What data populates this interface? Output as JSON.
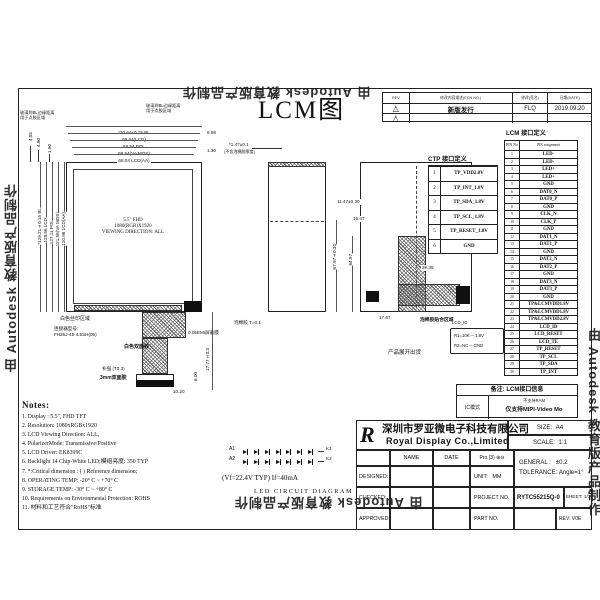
{
  "watermark": "由 Autodesk 教育版产品制作",
  "page_title": "LCM图",
  "revision_table": {
    "headers": [
      "REV",
      "修改内容描述(ECN NO.)",
      "修改(签名)",
      "日期(DATE)"
    ],
    "rows": [
      {
        "mark": "1",
        "desc": "新版发行",
        "by": "FLQ",
        "date": "2019.09.20"
      },
      {
        "mark": "2",
        "desc": "",
        "by": "",
        "date": ""
      }
    ]
  },
  "front_view": {
    "h_dims": [
      "*70.64±0.15 BL",
      "69.64(LCD)",
      "69.54 POL",
      "68.64(VA MOS)",
      "68.04 LCD(AA)"
    ],
    "h_side_dims": [
      "6.58",
      "1.30"
    ],
    "v_dims": [
      "*129.21±0.15 BL",
      "128.56 LCD",
      "127.11 POL",
      "121.56(VA MOS)",
      "120.96 LCD(AA)"
    ],
    "corner_dims": [
      "4.55",
      "4.60",
      "1.50"
    ],
    "glass_note_line1": "玻璃到BL边缘距离",
    "glass_note_line2": "用于点胶区域",
    "panel_label": [
      "5.5\" FHD",
      "1080(RGB)X1920",
      "VIEWING DIRECTION: ALL"
    ]
  },
  "fpc": {
    "silk_note": "白色丝印区域",
    "connector_note1": "连接器型号:",
    "connector_note2": "FH26J-45-4.5SH(05)",
    "emi_note": "0.05EMI屏蔽膜",
    "white_tape_note": "白色双面胶",
    "stiffener_note": "补强 (T0.3)",
    "tape_note": "3mm双面胶",
    "dim_w": "10.20",
    "dim_h": "6.00",
    "dim_len": "17.77±0.3"
  },
  "side_view": {
    "thickness_dim": "*1.47±0.1",
    "thickness_note": "(不含泡棉胶厚度)",
    "foam_note": "泡棉胶 T=0.1"
  },
  "back_view": {
    "dim1": "11.47±0.30",
    "dim2": "16.47",
    "dim3": "67.97±0.30",
    "dim4": "64.97",
    "dim5": "39.35",
    "dim6": "17.67",
    "foam_note": "泡棉胶贴合区域",
    "ship_note": "产品展开出货",
    "io_label": "LCD_IO",
    "io_r1": "R1=10K ─ 1.8V",
    "io_r2": "R2=NC ─ GND"
  },
  "ctp_table": {
    "title": "CTP 接口定义",
    "rows": [
      [
        "1",
        "TP_VDD2.8V"
      ],
      [
        "2",
        "TP_INT_1.8V"
      ],
      [
        "3",
        "TP_SDA_1.8V"
      ],
      [
        "4",
        "TP_SCL_1.8V"
      ],
      [
        "5",
        "TP_RESET_1.8V"
      ],
      [
        "6",
        "GND"
      ]
    ]
  },
  "lcm_table": {
    "title": "LCM 接口定义",
    "headers": [
      "PIN No",
      "PIN assignment"
    ],
    "rows": [
      [
        "1",
        "LED-"
      ],
      [
        "2",
        "LED-"
      ],
      [
        "3",
        "LED+"
      ],
      [
        "4",
        "LED+"
      ],
      [
        "5",
        "GND"
      ],
      [
        "6",
        "DAT0_N"
      ],
      [
        "7",
        "DAT0_P"
      ],
      [
        "8",
        "GND"
      ],
      [
        "9",
        "CLK_N"
      ],
      [
        "10",
        "CLK_P"
      ],
      [
        "11",
        "GND"
      ],
      [
        "12",
        "DAT1_N"
      ],
      [
        "13",
        "DAT1_P"
      ],
      [
        "14",
        "GND"
      ],
      [
        "15",
        "DAT2_N"
      ],
      [
        "16",
        "DAT2_P"
      ],
      [
        "17",
        "GND"
      ],
      [
        "18",
        "DAT3_N"
      ],
      [
        "19",
        "DAT3_P"
      ],
      [
        "20",
        "GND"
      ],
      [
        "21",
        "TP&LCMVDD1.8V"
      ],
      [
        "22",
        "TP&LCMVDD1.8V"
      ],
      [
        "23",
        "TP&LCMVDD2.8V"
      ],
      [
        "24",
        "LCD_ID"
      ],
      [
        "25",
        "LCD_RESET"
      ],
      [
        "26",
        "LCD_TE"
      ],
      [
        "27",
        "TP_RESET"
      ],
      [
        "28",
        "TP_SCL"
      ],
      [
        "29",
        "TP_SDA"
      ],
      [
        "30",
        "TP_INT"
      ]
    ]
  },
  "remark_table": {
    "header": "备注: LCM接口信息",
    "label": "IC模式",
    "line1": "不支持RAM",
    "line2": "仅支持MIPI-Video Mo"
  },
  "notes": {
    "heading": "Notes:",
    "items": [
      "1.  Display : 5.5\", FHD TFT",
      "2.  Resolution: 1080xRGBx1920",
      "3.  LCD Viewing Direction: ALL,",
      "4.  PolarizerMode: Transmissive/Positive",
      "5.  LCD Driver: EK8399C",
      "6.  Backlight 14 Chip-White LED;模组亮度: 350 TYP",
      "7.  *:Critical dimension : ( ) Reference dimension;",
      "8.  OPERATING TEMP: -20° C ~ +70° C",
      "9.  STORAGE TEMP: -30° C ~ +80° C",
      "10. Requirements on Environmental Protection: ROHS",
      "11. 材料和工艺符合\"RoHS\"标准"
    ]
  },
  "led_circuit": {
    "anodes": [
      "A1",
      "A2"
    ],
    "cathodes": [
      "K1",
      "K2"
    ],
    "per_row": 7,
    "spec": "(Vf=22.4V TYP)   If=40mA",
    "caption": "LED CIRCUIT DIAGRAM"
  },
  "title_block": {
    "logo_letter": "R",
    "company_cn": "深圳市罗亚微电子科技有限公司",
    "company_en": "Royal Display Co.,Limited",
    "size_label": "SIZE:",
    "size": "A4",
    "scale_label": "SCALE:",
    "scale": "1:1",
    "col_name": "NAME",
    "col_date": "DATE",
    "row_designed": "DESIGNED:",
    "row_checked": "CHECKED:",
    "row_approved": "APPROVED:",
    "projection": "Pro.(3)",
    "proj_symbol": "⊕⊖",
    "unit_label": "UNIT:",
    "unit": "MM",
    "project_label": "PROJECT NO.",
    "project_no": "RYTC55215Q-0",
    "part_label": "PART NO.",
    "general_label": "GENERAL :",
    "general_value": "±0.2",
    "tolerance_label": "TOLERANCE:",
    "tolerance_value": "Angle=1°",
    "sheet": "SHEET: 1/1",
    "rev_label": "REV:",
    "rev": "V0E"
  }
}
